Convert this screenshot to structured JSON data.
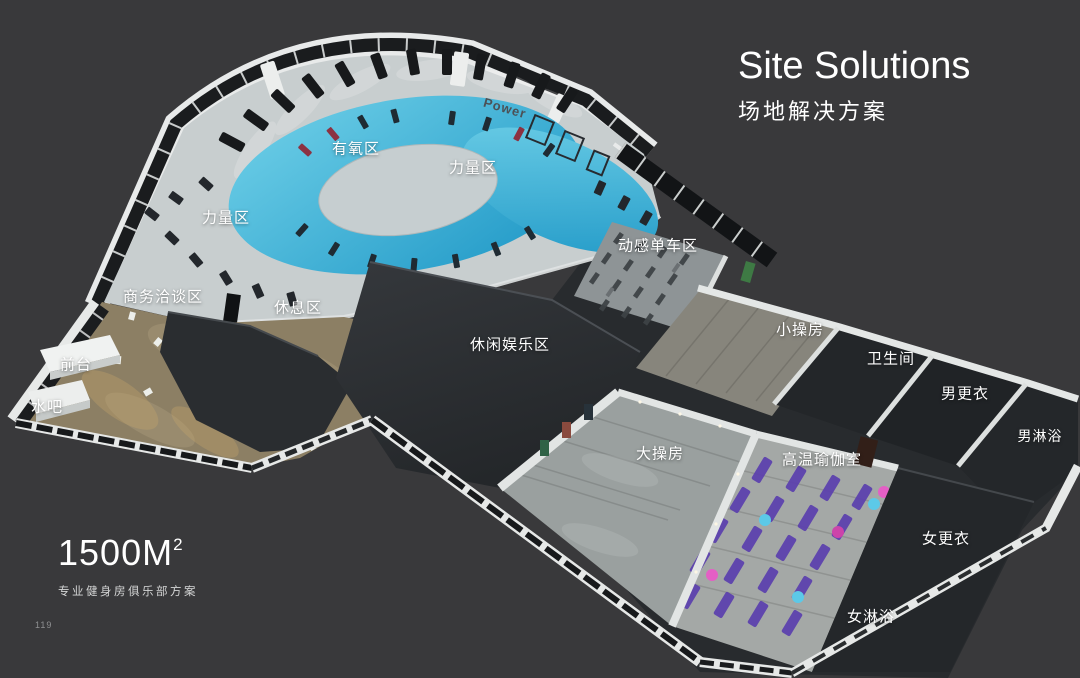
{
  "slide": {
    "title": "Site Solutions",
    "subtitle": "场地解决方案"
  },
  "areas": {
    "cardio": "有氧区",
    "strength_right": "力量区",
    "strength_left": "力量区",
    "spinning": "动感单车区",
    "small_studio": "小操房",
    "restroom": "卫生间",
    "men_locker": "男更衣",
    "men_shower": "男淋浴",
    "business_lounge": "商务洽谈区",
    "rest_area": "休息区",
    "front_desk": "前台",
    "water_bar": "水吧",
    "leisure": "休闲娱乐区",
    "big_studio": "大操房",
    "hot_yoga": "高温瑜伽室",
    "women_locker": "女更衣",
    "women_shower": "女淋浴"
  },
  "wall_text": {
    "power": "Power"
  },
  "footer": {
    "area_value": "1500M",
    "area_sup": "2",
    "caption": "专业健身房俱乐部方案",
    "page_number": "119"
  },
  "colors": {
    "background": "#39393b",
    "label_text": "#ffffff",
    "pool_blue": "#229ccb",
    "pool_blue_light": "#6fd0e8",
    "mat_purple": "#5b3fae",
    "ball_pink": "#e45fc5",
    "ball_cyan": "#5cc9e8",
    "floor_light": "#c8cecf",
    "carpet_tan": "#8c7f64",
    "roof_dark": "#2e3134",
    "wood_gray": "#9aa09f"
  }
}
